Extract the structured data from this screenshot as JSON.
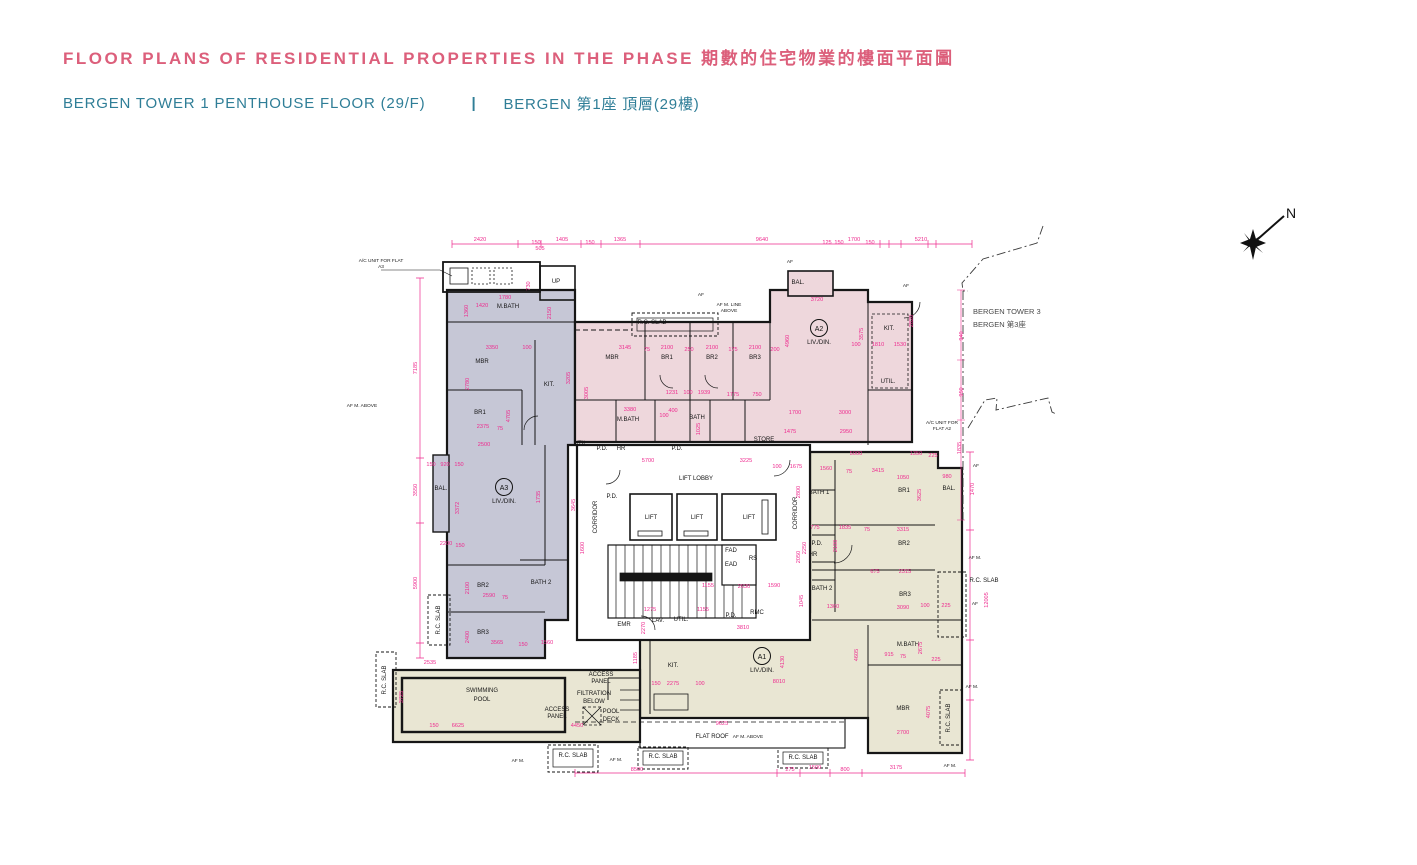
{
  "page": {
    "title": "FLOOR PLANS OF RESIDENTIAL PROPERTIES IN THE PHASE 期數的住宅物業的樓面平面圖",
    "subtitle_en": "BERGEN TOWER 1  PENTHOUSE FLOOR (29/F)",
    "divider": "|",
    "subtitle_zh": "BERGEN 第1座 頂層(29樓)"
  },
  "colors": {
    "title_pink": "#dc5f7b",
    "subtitle_teal": "#2f7e97",
    "dim_pink": "#ee2a8e",
    "wall": "#161616",
    "unit_a1": "#e9e6d3",
    "unit_a2": "#eed7dc",
    "unit_a3": "#c6c7d6",
    "white": "#ffffff"
  },
  "compass": {
    "label": "N"
  },
  "neighbor": {
    "line1": "BERGEN TOWER 3",
    "line2": "BERGEN 第3座"
  },
  "plan": {
    "units": [
      {
        "id": "A1",
        "sub": "LIV./DIN.",
        "x": 762,
        "y": 658
      },
      {
        "id": "A2",
        "sub": "LIV./DIN.",
        "x": 819,
        "y": 330
      },
      {
        "id": "A3",
        "sub": "LIV./DIN.",
        "x": 504,
        "y": 489
      }
    ],
    "room_labels": [
      [
        "MBR",
        482,
        363,
        0
      ],
      [
        "BR1",
        480,
        414,
        0
      ],
      [
        "KIT.",
        549,
        386,
        0
      ],
      [
        "M.BATH",
        508,
        308,
        0
      ],
      [
        "BAL.",
        441,
        490,
        0
      ],
      [
        "BR2",
        483,
        587,
        0
      ],
      [
        "BR3",
        483,
        634,
        0
      ],
      [
        "BATH 2",
        541,
        584,
        0
      ],
      [
        "UP",
        556,
        283,
        0
      ],
      [
        "MBR",
        612,
        359,
        0
      ],
      [
        "BR1",
        667,
        359,
        0
      ],
      [
        "BR2",
        712,
        359,
        0
      ],
      [
        "BR3",
        755,
        359,
        0
      ],
      [
        "KIT.",
        889,
        330,
        0
      ],
      [
        "BAL.",
        798,
        284,
        0
      ],
      [
        "M.BATH",
        628,
        421,
        0
      ],
      [
        "BATH",
        697,
        419,
        0
      ],
      [
        "UTIL.",
        888,
        383,
        0
      ],
      [
        "STORE",
        764,
        441,
        0
      ],
      [
        "UTIL.",
        581,
        445,
        0
      ],
      [
        "LIFT LOBBY",
        696,
        480,
        0
      ],
      [
        "LIFT",
        651,
        519,
        0
      ],
      [
        "LIFT",
        697,
        519,
        0
      ],
      [
        "LIFT",
        749,
        519,
        0
      ],
      [
        "CORRIDOR",
        597,
        517,
        1
      ],
      [
        "CORRIDOR",
        797,
        513,
        1
      ],
      [
        "P.D.",
        612,
        498,
        0
      ],
      [
        "P.D.",
        602,
        450,
        0
      ],
      [
        "HR",
        621,
        450,
        0
      ],
      [
        "P.D.",
        677,
        450,
        0
      ],
      [
        "FAD",
        731,
        552,
        0
      ],
      [
        "EAD",
        731,
        566,
        0
      ],
      [
        "RS",
        753,
        560,
        0
      ],
      [
        "EMR",
        624,
        626,
        0
      ],
      [
        "LAV.",
        658,
        622,
        0
      ],
      [
        "UTIL.",
        681,
        621,
        0
      ],
      [
        "P.D.",
        731,
        617,
        0
      ],
      [
        "RMC",
        757,
        614,
        0
      ],
      [
        "BR1",
        904,
        492,
        0
      ],
      [
        "BR2",
        904,
        545,
        0
      ],
      [
        "BR3",
        905,
        596,
        0
      ],
      [
        "MBR",
        903,
        710,
        0
      ],
      [
        "M.BATH",
        908,
        646,
        0
      ],
      [
        "BATH 1",
        819,
        494,
        0
      ],
      [
        "BATH 2",
        822,
        590,
        0
      ],
      [
        "P.D.",
        817,
        545,
        0
      ],
      [
        "HR",
        813,
        556,
        0
      ],
      [
        "BAL.",
        949,
        490,
        0
      ],
      [
        "KIT.",
        673,
        667,
        0
      ],
      [
        "SWIMMING",
        482,
        692,
        0
      ],
      [
        "POOL",
        482,
        701,
        0
      ],
      [
        "FILTRATION",
        594,
        695,
        0
      ],
      [
        "BELOW",
        594,
        703,
        0
      ],
      [
        "POOL",
        611,
        713,
        0
      ],
      [
        "DECK",
        611,
        721,
        0
      ],
      [
        "ACCESS",
        557,
        711,
        0
      ],
      [
        "PANEL",
        557,
        718,
        0
      ],
      [
        "ACCESS",
        601,
        676,
        0
      ],
      [
        "PANEL",
        601,
        683,
        0
      ],
      [
        "FLAT ROOF",
        712,
        738,
        0
      ],
      [
        "R.C. SLAB",
        652,
        324,
        0
      ],
      [
        "R.C. SLAB",
        573,
        757,
        0
      ],
      [
        "R.C. SLAB",
        663,
        758,
        0
      ],
      [
        "R.C. SLAB",
        803,
        759,
        0
      ],
      [
        "R.C. SLAB",
        440,
        620,
        1
      ],
      [
        "R.C. SLAB",
        386,
        680,
        1
      ],
      [
        "R.C. SLAB",
        950,
        718,
        1
      ],
      [
        "R.C. SLAB",
        984,
        582,
        0
      ]
    ],
    "callouts": [
      [
        "A/C UNIT FOR FLAT",
        381,
        262
      ],
      [
        "A3",
        381,
        268
      ],
      [
        "A/C UNIT FOR",
        942,
        424
      ],
      [
        "FLAT A2",
        942,
        430
      ],
      [
        "AF M. LINE",
        729,
        306
      ],
      [
        "ABOVE",
        729,
        312
      ],
      [
        "AF M. ABOVE",
        362,
        407
      ],
      [
        "AF M. ABOVE",
        748,
        738
      ],
      [
        "AF M.",
        975,
        559
      ],
      [
        "AF",
        975,
        605
      ],
      [
        "AF",
        976,
        467
      ],
      [
        "AF M.",
        972,
        688
      ],
      [
        "AF M.",
        950,
        767
      ],
      [
        "AF M.",
        616,
        761
      ],
      [
        "AF M.",
        518,
        762
      ],
      [
        "AF",
        701,
        296
      ],
      [
        "AF",
        790,
        263
      ],
      [
        "AF",
        906,
        287
      ]
    ],
    "dim_labels": [
      [
        "2420",
        480,
        241,
        0
      ],
      [
        "150",
        536,
        244,
        0
      ],
      [
        "1405",
        562,
        241,
        0
      ],
      [
        "150",
        590,
        244,
        0
      ],
      [
        "505",
        540,
        250,
        0
      ],
      [
        "1365",
        620,
        241,
        0
      ],
      [
        "9640",
        762,
        241,
        0
      ],
      [
        "125",
        827,
        244,
        0
      ],
      [
        "150",
        839,
        244,
        0
      ],
      [
        "1700",
        854,
        241,
        0
      ],
      [
        "150",
        870,
        244,
        0
      ],
      [
        "5210",
        921,
        241,
        0
      ],
      [
        "7185",
        417,
        368,
        1
      ],
      [
        "3550",
        417,
        490,
        1
      ],
      [
        "5900",
        417,
        583,
        1
      ],
      [
        "1360",
        468,
        311,
        1
      ],
      [
        "1420",
        482,
        307,
        0
      ],
      [
        "1780",
        505,
        299,
        0
      ],
      [
        "730",
        530,
        286,
        1
      ],
      [
        "2150",
        551,
        313,
        1
      ],
      [
        "3350",
        492,
        349,
        0
      ],
      [
        "100",
        527,
        349,
        0
      ],
      [
        "2780",
        469,
        384,
        1
      ],
      [
        "4705",
        510,
        416,
        1
      ],
      [
        "2375",
        483,
        428,
        0
      ],
      [
        "75",
        500,
        430,
        0
      ],
      [
        "2500",
        484,
        446,
        0
      ],
      [
        "920",
        445,
        466,
        0
      ],
      [
        "150",
        431,
        466,
        0
      ],
      [
        "150",
        459,
        466,
        0
      ],
      [
        "3372",
        459,
        508,
        1
      ],
      [
        "1735",
        540,
        497,
        1
      ],
      [
        "3645",
        575,
        505,
        1
      ],
      [
        "2200",
        446,
        545,
        0
      ],
      [
        "150",
        460,
        547,
        0
      ],
      [
        "2100",
        469,
        588,
        1
      ],
      [
        "2590",
        489,
        597,
        0
      ],
      [
        "75",
        505,
        599,
        0
      ],
      [
        "2400",
        469,
        637,
        1
      ],
      [
        "3565",
        497,
        644,
        0
      ],
      [
        "150",
        523,
        646,
        0
      ],
      [
        "1560",
        547,
        644,
        0
      ],
      [
        "3145",
        625,
        349,
        0
      ],
      [
        "75",
        647,
        351,
        0
      ],
      [
        "2100",
        667,
        349,
        0
      ],
      [
        "250",
        689,
        351,
        0
      ],
      [
        "2100",
        712,
        349,
        0
      ],
      [
        "175",
        733,
        351,
        0
      ],
      [
        "2100",
        755,
        349,
        0
      ],
      [
        "200",
        775,
        351,
        0
      ],
      [
        "3205",
        570,
        378,
        1
      ],
      [
        "3005",
        588,
        393,
        1
      ],
      [
        "1231",
        672,
        394,
        0
      ],
      [
        "100",
        688,
        394,
        0
      ],
      [
        "1939",
        704,
        394,
        0
      ],
      [
        "1775",
        733,
        396,
        0
      ],
      [
        "750",
        757,
        396,
        0
      ],
      [
        "3380",
        630,
        411,
        0
      ],
      [
        "100",
        664,
        417,
        0
      ],
      [
        "400",
        673,
        412,
        0
      ],
      [
        "1025",
        700,
        429,
        1
      ],
      [
        "3720",
        817,
        301,
        0
      ],
      [
        "4960",
        789,
        341,
        1
      ],
      [
        "3575",
        863,
        334,
        1
      ],
      [
        "2820",
        913,
        321,
        1
      ],
      [
        "1810",
        878,
        346,
        0
      ],
      [
        "100",
        856,
        346,
        0
      ],
      [
        "1530",
        900,
        346,
        0
      ],
      [
        "1700",
        795,
        414,
        0
      ],
      [
        "3000",
        845,
        414,
        0
      ],
      [
        "1475",
        790,
        433,
        0
      ],
      [
        "2950",
        846,
        433,
        0
      ],
      [
        "940",
        963,
        336,
        1
      ],
      [
        "950",
        963,
        392,
        1
      ],
      [
        "1835",
        961,
        448,
        1
      ],
      [
        "5700",
        648,
        462,
        0
      ],
      [
        "3225",
        746,
        462,
        0
      ],
      [
        "100",
        777,
        468,
        0
      ],
      [
        "1675",
        796,
        468,
        0
      ],
      [
        "1560",
        826,
        470,
        0
      ],
      [
        "3415",
        878,
        472,
        0
      ],
      [
        "75",
        849,
        473,
        0
      ],
      [
        "5000",
        856,
        455,
        0
      ],
      [
        "1350",
        916,
        455,
        0
      ],
      [
        "225",
        933,
        457,
        0
      ],
      [
        "1050",
        903,
        479,
        0
      ],
      [
        "980",
        947,
        478,
        0
      ],
      [
        "3625",
        921,
        495,
        1
      ],
      [
        "1470",
        974,
        489,
        1
      ],
      [
        "12005",
        988,
        600,
        1
      ],
      [
        "775",
        815,
        529,
        0
      ],
      [
        "1835",
        845,
        529,
        0
      ],
      [
        "3315",
        903,
        531,
        0
      ],
      [
        "75",
        867,
        531,
        0
      ],
      [
        "2250",
        806,
        548,
        1
      ],
      [
        "2100",
        837,
        546,
        1
      ],
      [
        "675",
        875,
        573,
        0
      ],
      [
        "2315",
        905,
        573,
        0
      ],
      [
        "1045",
        803,
        601,
        1
      ],
      [
        "1360",
        833,
        608,
        0
      ],
      [
        "3090",
        903,
        609,
        0
      ],
      [
        "1590",
        774,
        587,
        0
      ],
      [
        "2630",
        744,
        588,
        0
      ],
      [
        "1155",
        708,
        587,
        0
      ],
      [
        "1275",
        650,
        611,
        0
      ],
      [
        "1155",
        703,
        611,
        0
      ],
      [
        "915",
        889,
        656,
        0
      ],
      [
        "75",
        903,
        658,
        0
      ],
      [
        "225",
        936,
        661,
        0
      ],
      [
        "2675",
        922,
        648,
        1
      ],
      [
        "4605",
        858,
        655,
        1
      ],
      [
        "2700",
        903,
        734,
        0
      ],
      [
        "4075",
        930,
        712,
        1
      ],
      [
        "8010",
        779,
        683,
        0
      ],
      [
        "4130",
        784,
        662,
        1
      ],
      [
        "2275",
        673,
        685,
        0
      ],
      [
        "150",
        656,
        685,
        0
      ],
      [
        "100",
        700,
        685,
        0
      ],
      [
        "9625",
        722,
        725,
        0
      ],
      [
        "3810",
        743,
        629,
        0
      ],
      [
        "6625",
        458,
        727,
        0
      ],
      [
        "4450",
        577,
        727,
        0
      ],
      [
        "150",
        434,
        727,
        0
      ],
      [
        "3725",
        403,
        697,
        1
      ],
      [
        "2535",
        430,
        664,
        0
      ],
      [
        "1185",
        637,
        658,
        1
      ],
      [
        "2270",
        645,
        628,
        1
      ],
      [
        "1600",
        584,
        548,
        1
      ],
      [
        "2800",
        800,
        492,
        1
      ],
      [
        "2050",
        800,
        557,
        1
      ],
      [
        "8500",
        637,
        771,
        0
      ],
      [
        "275",
        790,
        771,
        0
      ],
      [
        "1500",
        815,
        769,
        0
      ],
      [
        "800",
        845,
        771,
        0
      ],
      [
        "3175",
        896,
        769,
        0
      ],
      [
        "100",
        925,
        607,
        0
      ],
      [
        "225",
        946,
        607,
        0
      ]
    ]
  }
}
